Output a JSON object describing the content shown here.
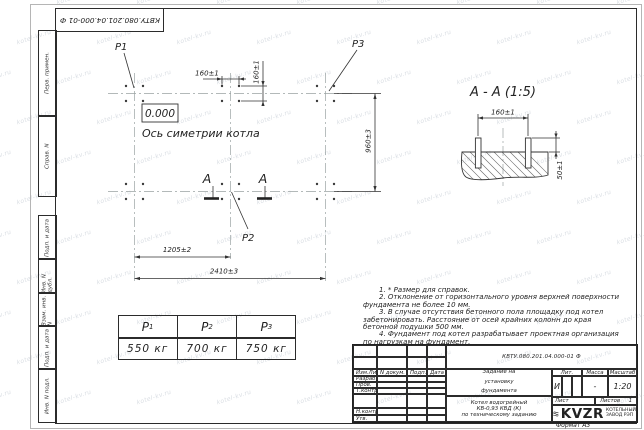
{
  "watermark": {
    "text": "kotel-kv.ru"
  },
  "frame": {
    "top_stamp": "КВТУ.080.201.04.000-01 Ф",
    "side_labels": [
      "Перв. примен.",
      "Справ. N",
      "Подп. и дата",
      "Инв. N дубл.",
      "Взам. инв. N",
      "Подп. и дата",
      "Инв. N подл."
    ],
    "format_label": "Формат А3"
  },
  "plan": {
    "p1": "P1",
    "p2": "P2",
    "p3": "P3",
    "level_mark": "0.000",
    "axis_label": "Ось симетрии котла",
    "section_letter": "А",
    "dim_bolt_x": "160±1",
    "dim_bolt_y": "160±1",
    "dim_rows": "960±3",
    "dim_half": "1205±2",
    "dim_full": "2410±3"
  },
  "section": {
    "title": "А - А (1:5)",
    "dim_bolts": "160±1",
    "dim_height": "50±1"
  },
  "load_table": {
    "columns": [
      {
        "label": "P",
        "sub": "1",
        "value": "550 кг"
      },
      {
        "label": "P",
        "sub": "2",
        "value": "700 кг"
      },
      {
        "label": "P",
        "sub": "3",
        "value": "750 кг"
      }
    ]
  },
  "notes": [
    "1. * Размер для справок.",
    "2. Отклонение от горизонтального уровня верхней поверхности фундамента не более 10 мм.",
    "3. В случае отсутствия бетонного пола площадку под котел забетонировать. Расстояние от осей крайних колонн до края бетонной подушки 500 мм.",
    "4. Фундамент под котел разрабатывает проектная организация по нагрузкам на фундамент."
  ],
  "title_block": {
    "doc_number": "КВТУ.080.201.04.000-01 Ф",
    "title": "Задание на\nустановку\nфундамента",
    "subtitle": "Котел водогрейный\nКВ-0,93 КВД (К)\nпо техническому заданию",
    "col_izm": "Изм.Лист",
    "col_doc": "N докум.",
    "col_podp": "Подп.",
    "col_data": "Дата",
    "row_razrab": "Разраб.",
    "row_prov": "Пров.",
    "row_tkontr": "Т.контр.",
    "row_nkontr": "Н.контр.",
    "row_utv": "Утв.",
    "lit_label": "Лит.",
    "lit_value": "И",
    "mass_label": "Масса",
    "mass_value": "-",
    "scale_label": "Масштаб",
    "scale_value": "1:20",
    "sheet_label": "Лист",
    "sheets_label": "Листов",
    "sheets_value": "1",
    "logo_text": "KVZR",
    "logo_caption": "КОТЕЛЬНЫЙ\nЗАВОД РЭП"
  }
}
